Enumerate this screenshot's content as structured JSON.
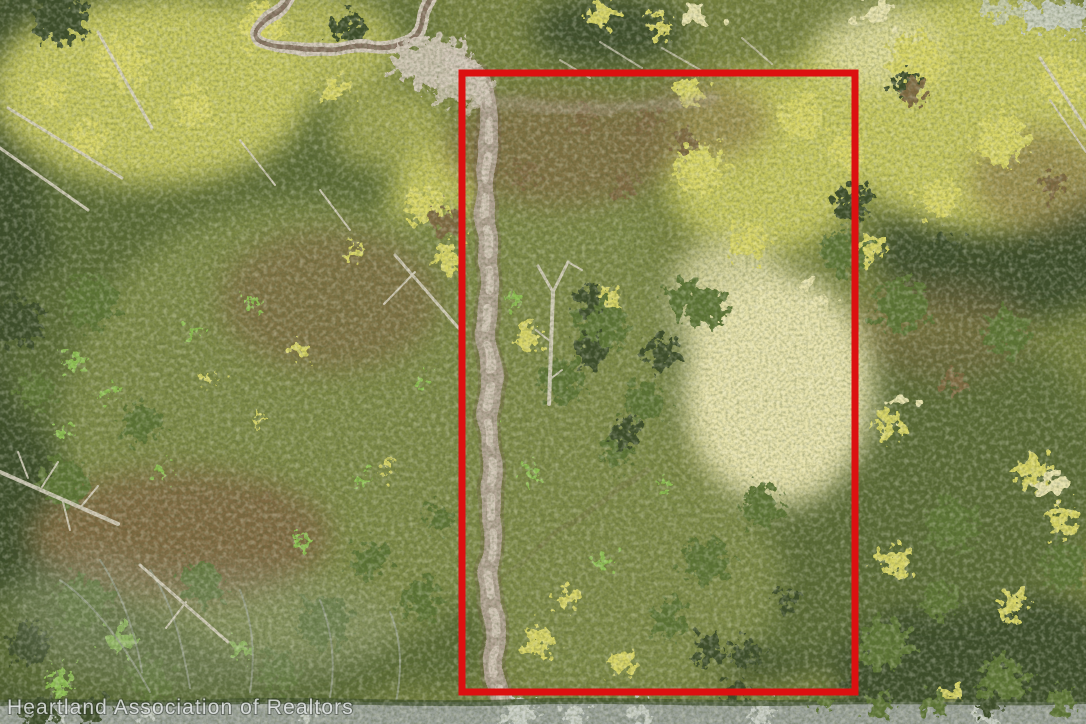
{
  "watermark": {
    "text": "Heartland Association of Realtors",
    "color": "#e4e7e7"
  },
  "parcel": {
    "outline_color": "#dc1010"
  },
  "palette": {
    "base_olive": "#76813f",
    "dark_forest": "#3c4e2a",
    "forest_green": "#5a6b35",
    "sun_canopy": "#c6c75f",
    "bright_canopy": "#d8d566",
    "cream_canopy": "#e7e2ac",
    "mid_green": "#5d7536",
    "fern_green": "#8fc152",
    "scrub_olive": "#7d8947",
    "rust_brown": "#7f6a42",
    "snag_pale": "#d8d2c2",
    "wisp_gray": "#9aa28f",
    "trail_pale": "#d3c8ba",
    "trail_mid": "#b3a396",
    "dirt_dark": "#6e5744",
    "road_gray": "#9aa199",
    "road_pale": "#c9cec6"
  }
}
